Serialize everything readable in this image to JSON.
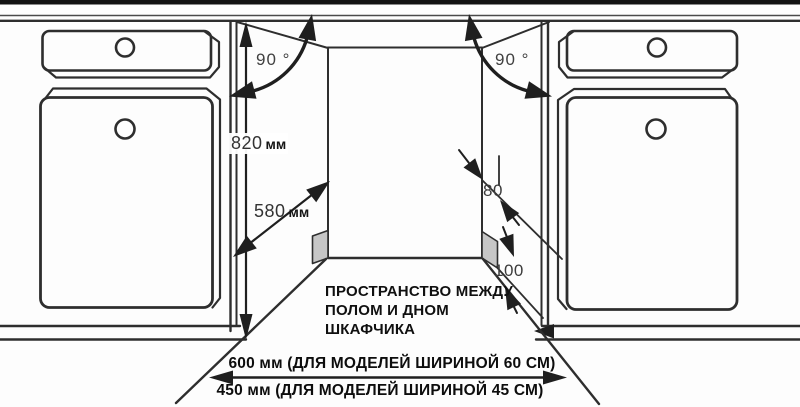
{
  "diagram": {
    "title_semantic": "built-in dishwasher niche installation dimensions",
    "colors": {
      "line": "#2e2e2e",
      "arrow": "#1f1f1f",
      "plinth_fill": "#c6c6c6",
      "background": "#fdfdfd"
    },
    "labels": {
      "angle_left": "90 °",
      "angle_right": "90 °",
      "height": {
        "value": "820",
        "unit": "мм"
      },
      "depth": {
        "value": "580",
        "unit": "мм"
      },
      "recess_depth": "80",
      "recess_height": "100",
      "note_lines": [
        "ПРОСТРАНСТВО МЕЖДУ",
        "ПОЛОМ И ДНОМ",
        "ШКАФЧИКА"
      ],
      "width_60": "600 мм (ДЛЯ МОДЕЛЕЙ ШИРИНОЙ 60 СМ)",
      "width_45": "450 мм (ДЛЯ МОДЕЛЕЙ ШИРИНОЙ 45 СМ)"
    }
  }
}
